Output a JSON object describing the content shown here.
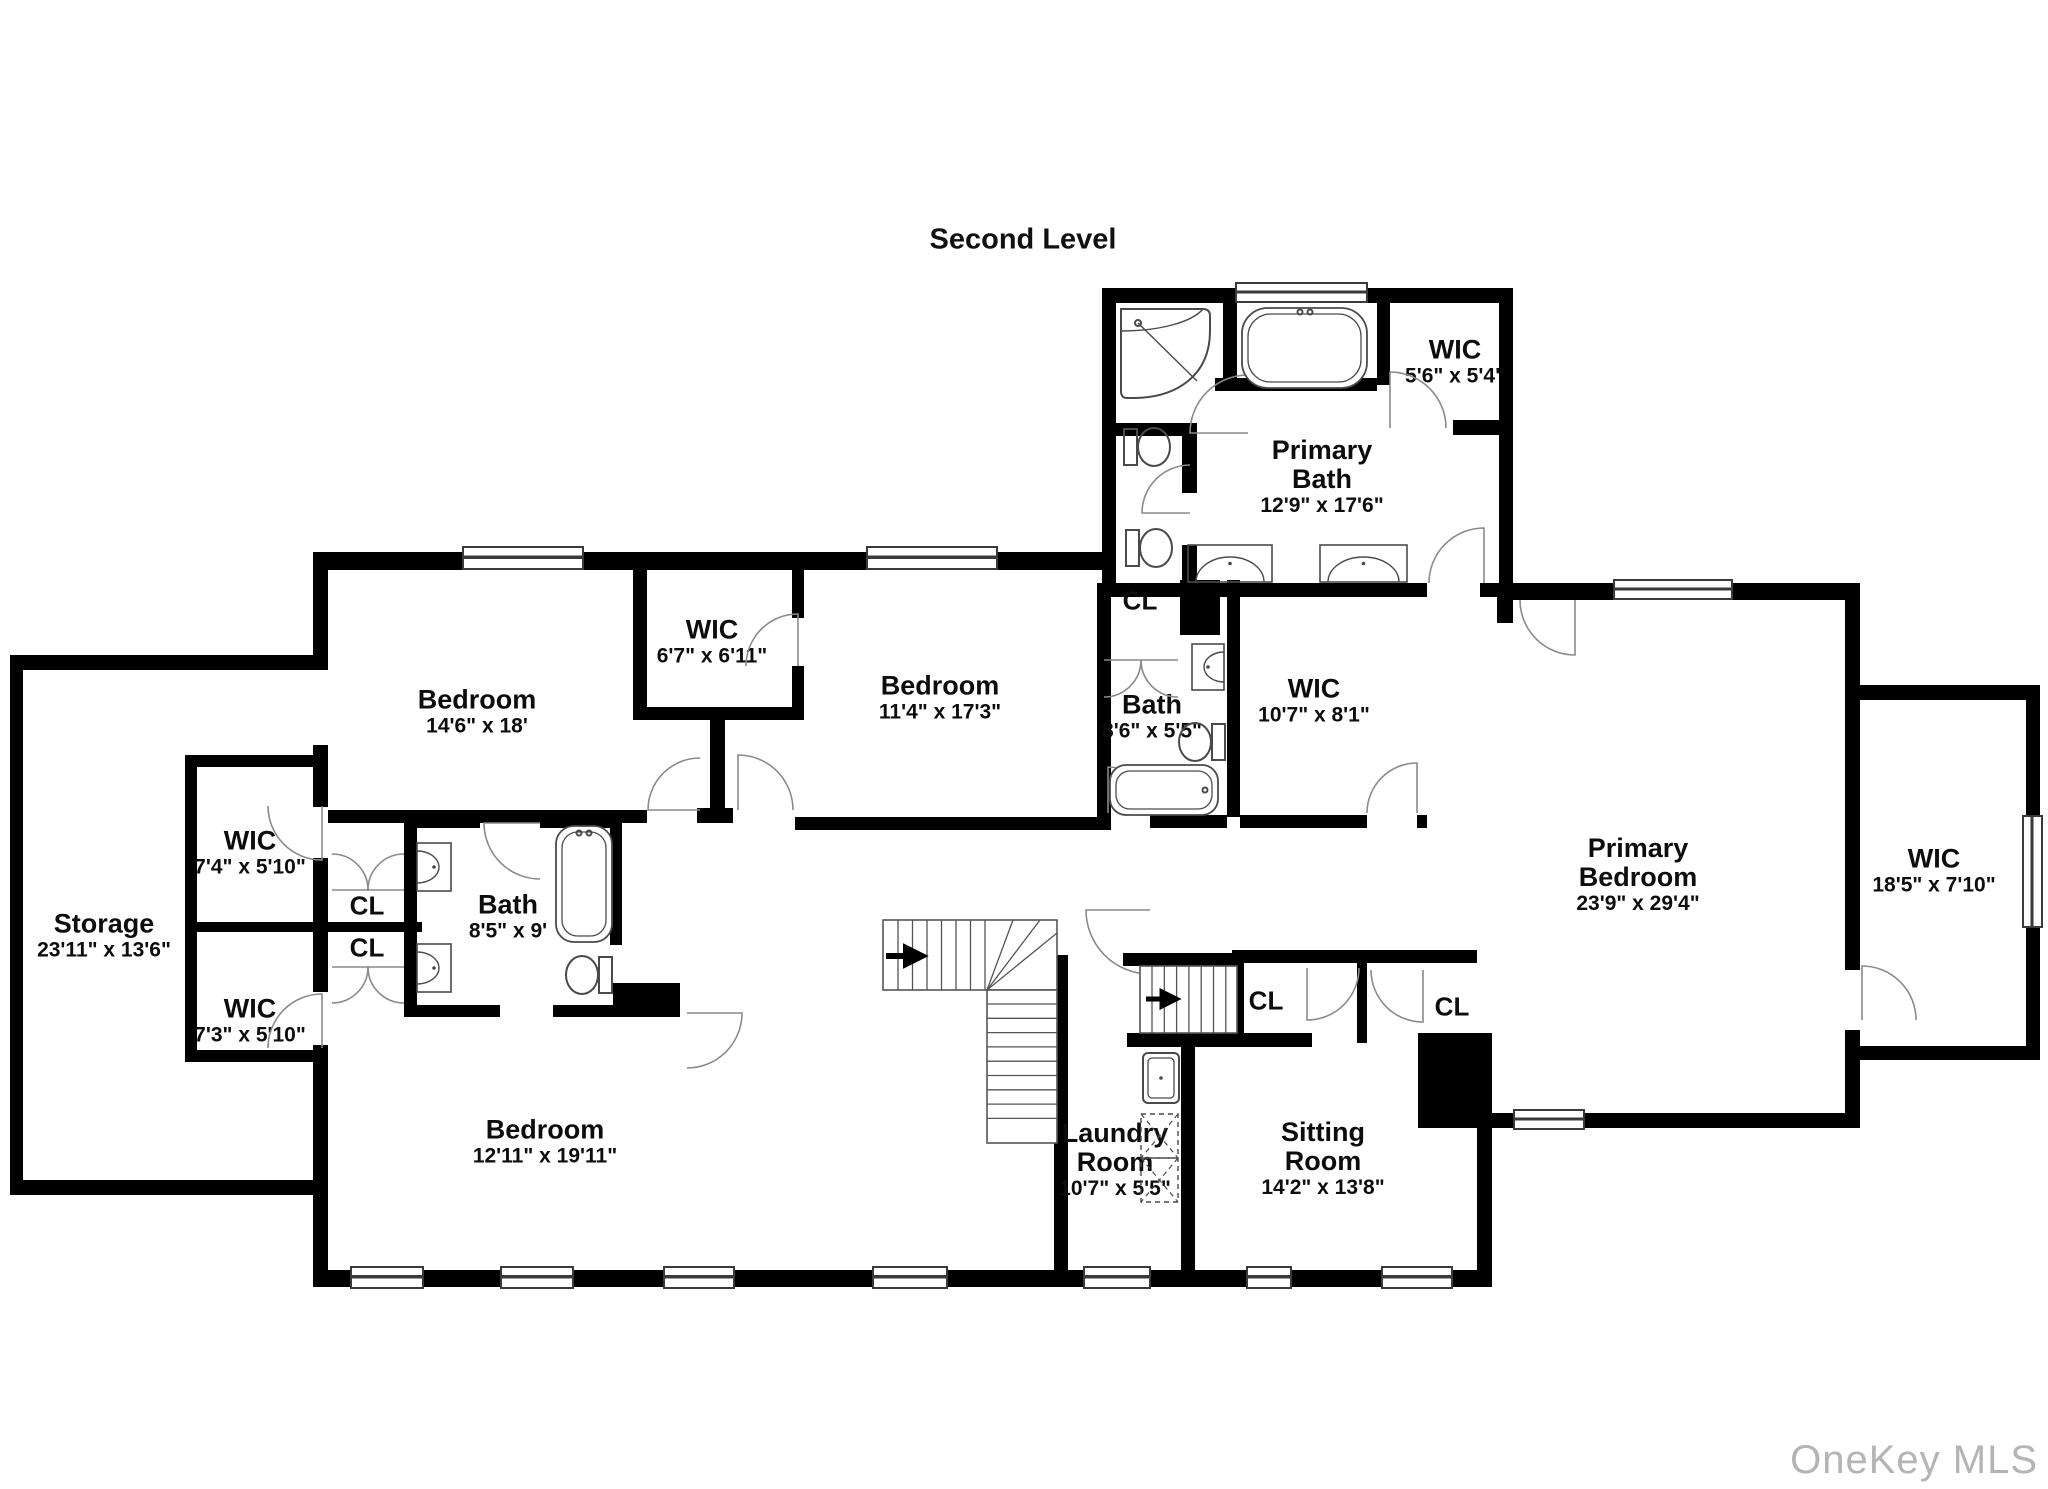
{
  "title": "Second Level",
  "watermark": "OneKey MLS",
  "closet_label": "CL",
  "rooms": {
    "primary_bath": {
      "name": "Primary\nBath",
      "dims": "12'9\" x 17'6\""
    },
    "wic_primary": {
      "name": "WIC",
      "dims": "5'6\" x 5'4\""
    },
    "bedroom_left": {
      "name": "Bedroom",
      "dims": "14'6\" x 18'"
    },
    "wic_center": {
      "name": "WIC",
      "dims": "6'7\" x 6'11\""
    },
    "bedroom_middle": {
      "name": "Bedroom",
      "dims": "11'4\" x 17'3\""
    },
    "bath_middle": {
      "name": "Bath",
      "dims": "8'6\" x 5'5\""
    },
    "wic_hall": {
      "name": "WIC",
      "dims": "10'7\" x 8'1\""
    },
    "primary_bedroom": {
      "name": "Primary\nBedroom",
      "dims": "23'9\" x 29'4\""
    },
    "wic_primary_large": {
      "name": "WIC",
      "dims": "18'5\" x 7'10\""
    },
    "storage": {
      "name": "Storage",
      "dims": "23'11\" x 13'6\""
    },
    "wic_left_upper": {
      "name": "WIC",
      "dims": "7'4\" x 5'10\""
    },
    "wic_left_lower": {
      "name": "WIC",
      "dims": "7'3\" x 5'10\""
    },
    "bath_left": {
      "name": "Bath",
      "dims": "8'5\" x 9'"
    },
    "bedroom_bottom": {
      "name": "Bedroom",
      "dims": "12'11\" x 19'11\""
    },
    "laundry": {
      "name": "Laundry\nRoom",
      "dims": "10'7\" x 5'5\""
    },
    "sitting": {
      "name": "Sitting\nRoom",
      "dims": "14'2\" x 13'8\""
    }
  }
}
